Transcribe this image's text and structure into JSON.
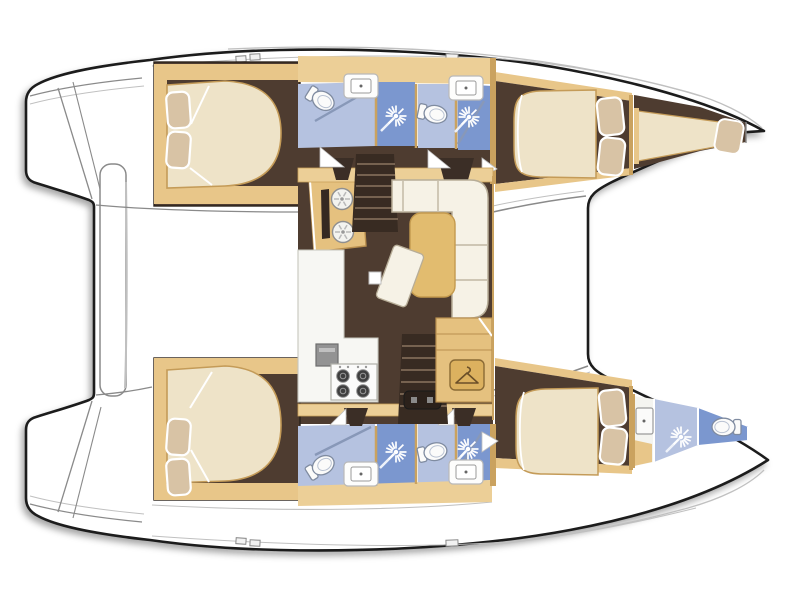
{
  "page": {
    "title": "Catamaran sailing yacht interior deck plan (top view, bow to the right)",
    "background": "#ffffff"
  },
  "legend": {
    "vessel_type": "catamaran sailing yacht floor plan",
    "orientation": "bow pointing right, sterns with swim platforms on the left",
    "port_hull_top": {
      "aft_cabin": {
        "double_bed": 1,
        "pillows": 2
      },
      "aft_bathroom": {
        "toilet": 1,
        "shower": 1,
        "washbasin": 1
      },
      "forward_bathroom": {
        "toilet": 1,
        "shower": 1,
        "washbasin": 1
      },
      "forward_cabin": {
        "double_bed": 1,
        "pillows": 2
      },
      "forepeak": {
        "single_berth": 1,
        "pillow": 1
      }
    },
    "starboard_hull_bottom": {
      "aft_cabin": {
        "double_bed": 1,
        "pillows": 2
      },
      "aft_bathroom": {
        "toilet": 1,
        "shower": 1,
        "washbasin": 1
      },
      "forward_bathroom": {
        "toilet": 1,
        "shower": 1,
        "washbasin": 1
      },
      "forward_cabin": {
        "double_bed": 1,
        "pillows": 2
      },
      "bow_bathroom": {
        "toilet": 1,
        "shower": 1,
        "washbasin": 1
      }
    },
    "saloon": {
      "galley_twin_sinks": 2,
      "oven": 1,
      "stove_burners": 4,
      "l_sofa": 1,
      "dining_table": 1,
      "chaise": 1,
      "stool": 1,
      "wardrobe": 1,
      "staircases": 2,
      "entry_step": 1
    },
    "aft_deck": {
      "central_platform": 1
    }
  },
  "icons": [
    "shower-sunburst-icon",
    "toilet-icon",
    "washbasin-icon",
    "galley-sink-icon",
    "stove-burner-icon",
    "wardrobe-hanger-icon"
  ],
  "colors": {
    "white": "#ffffff",
    "outline": "#1b1b1b",
    "lineGray": "#8a8a8a",
    "lineLight": "#c0c0c0",
    "floorDark": "#4e3c30",
    "stairDark": "#382b22",
    "stepLine": "#8a7460",
    "doorDark": "#3b2e26",
    "wood": "#e8c689",
    "woodBand": "#eccf97",
    "woodDark": "#caa25f",
    "woodTable": "#e2bc6f",
    "woodCab": "#e5c17f",
    "bedBase": "#eee3c8",
    "bedLine": "#c49b58",
    "pillow": "#d8c3a5",
    "sofa": "#f6f2e6",
    "sofaLine": "#b7ad97",
    "counter": "#f7f7f3",
    "counterLine": "#c6c6bd",
    "ovenGray": "#939393",
    "burner": "#3f3f3f",
    "blueLight": "#b5c2e0",
    "blueDeep": "#7b97cf",
    "fixture": "#fbfbfa",
    "fixtureLine": "#7f8ba0",
    "glass": "#8898b8",
    "tipWhite": "#f4f4f0"
  }
}
